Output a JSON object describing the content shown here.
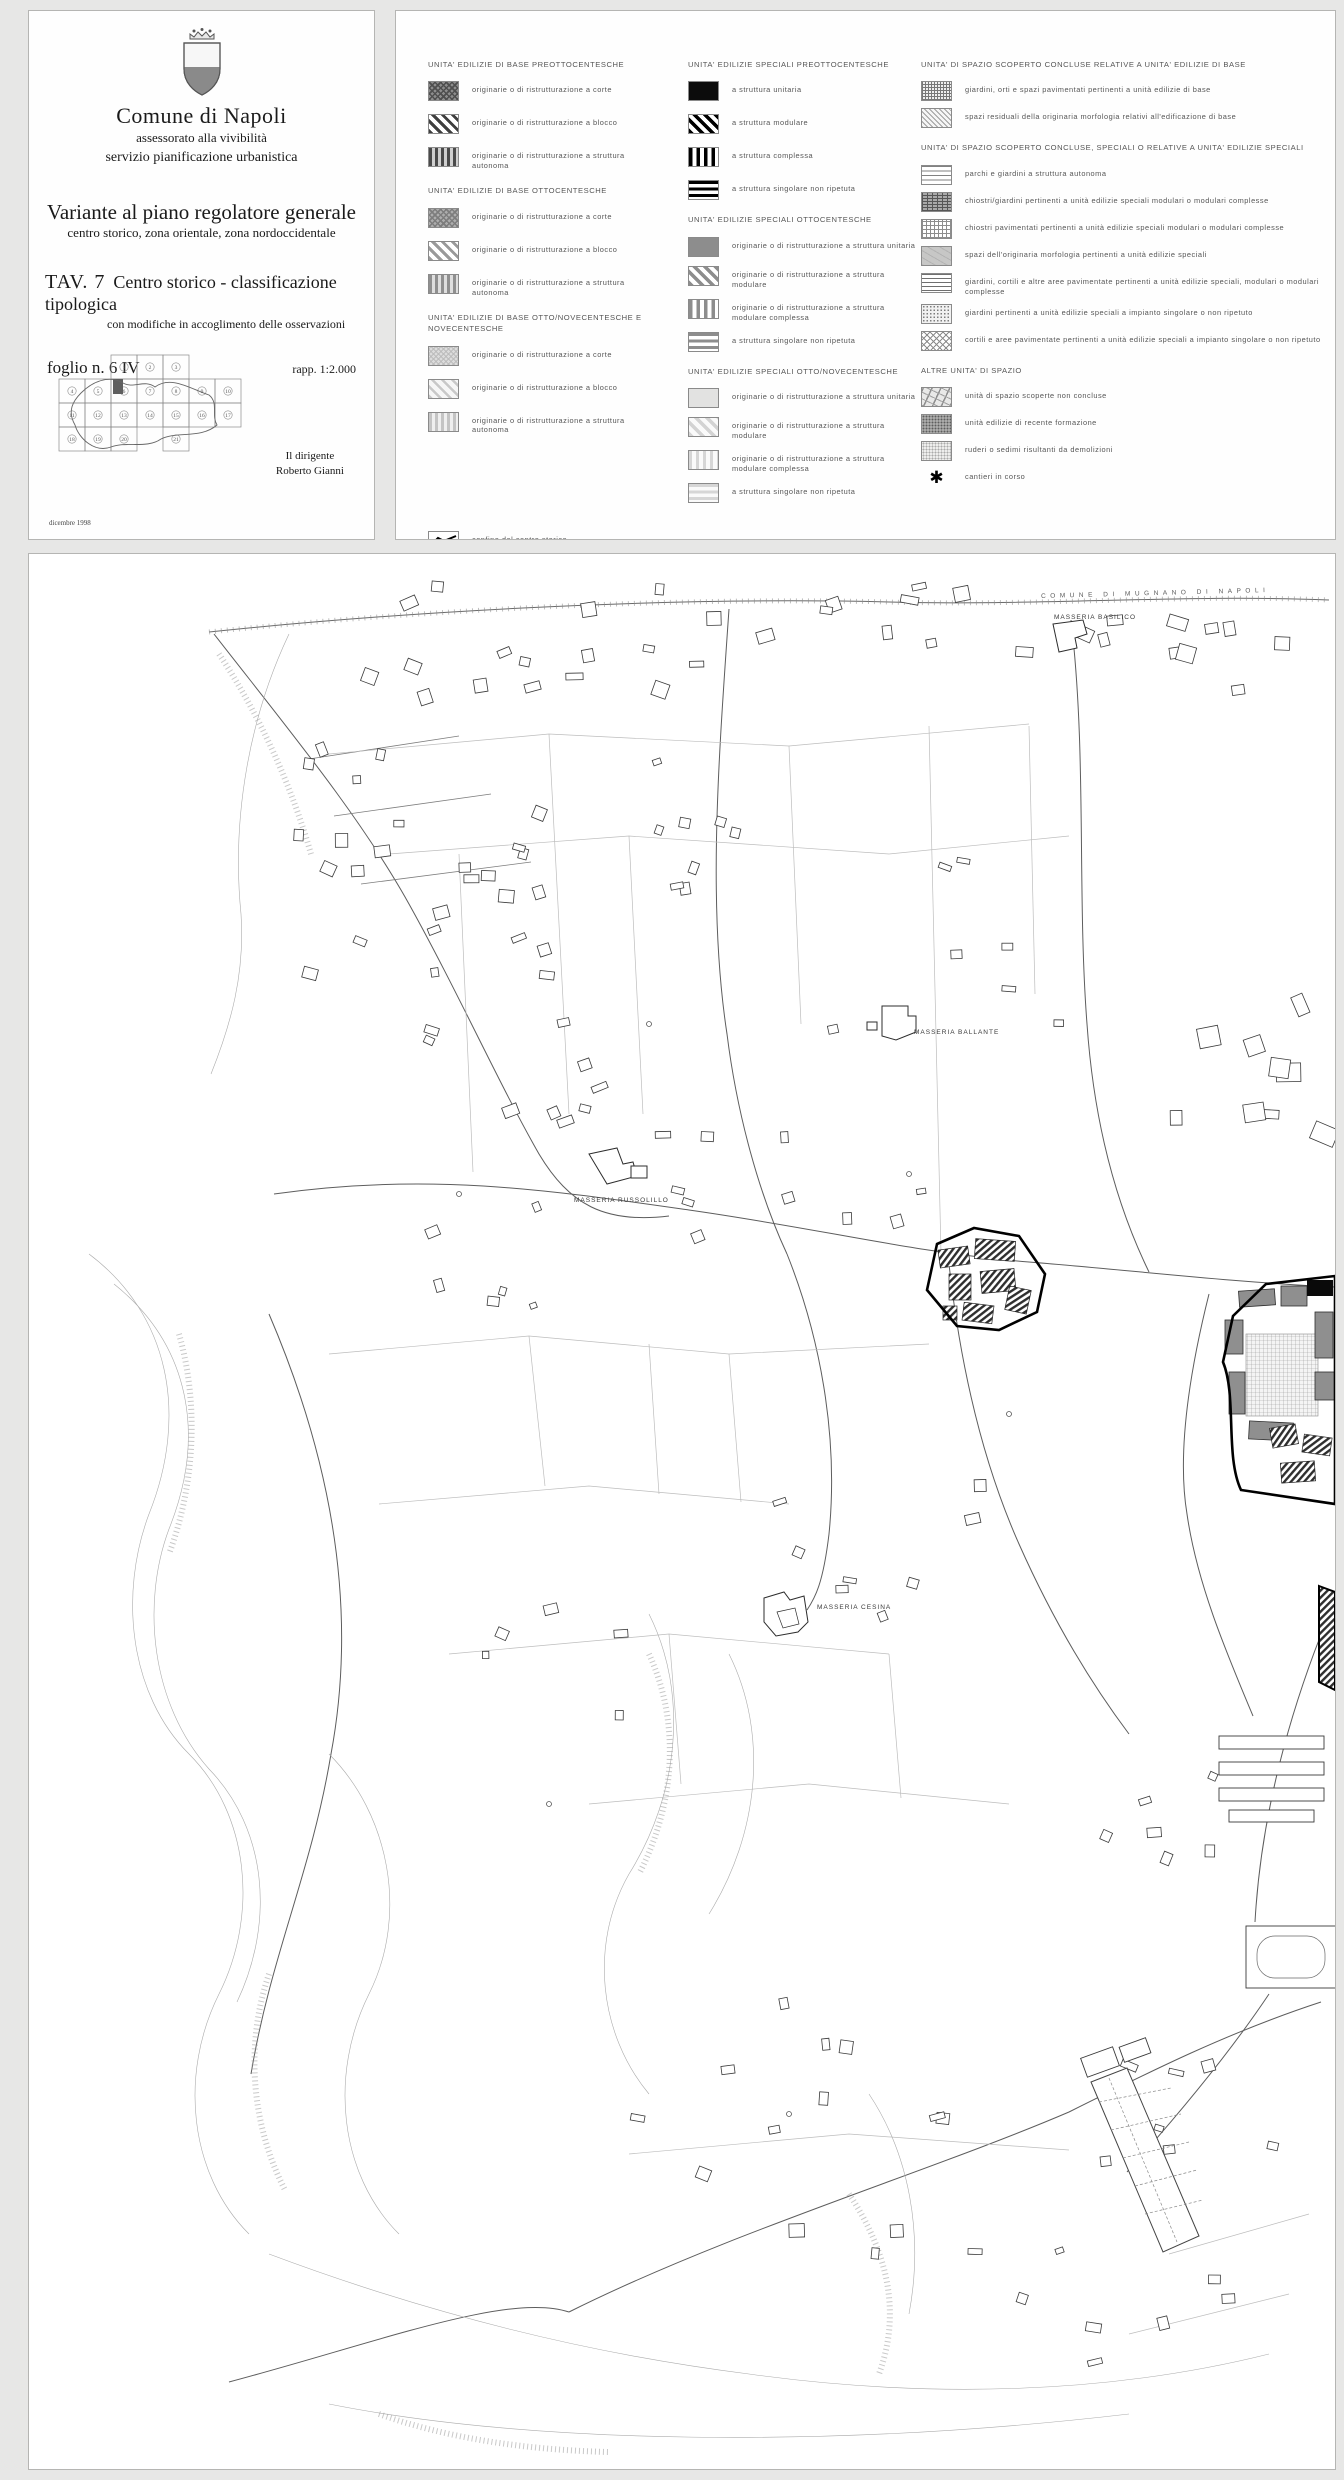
{
  "colors": {
    "ink": "#1a1a1a",
    "legend_text": "#565656",
    "map_line": "#444444",
    "historic_boundary": "#000000",
    "paper": "#ffffff",
    "shield_gray": "#8a8a8a"
  },
  "title_block": {
    "org": "Comune di Napoli",
    "dept1": "assessorato alla vivibilità",
    "dept2": "servizio pianificazione urbanistica",
    "plan_title": "Variante al piano regolatore generale",
    "plan_subtitle": "centro storico, zona orientale, zona nordoccidentale",
    "tav_no": "TAV. 7",
    "tav_title": "Centro storico - classificazione tipologica",
    "tav_note": "con modifiche in accoglimento delle osservazioni",
    "sheet": "foglio n. 6 IV",
    "scale": "rapp. 1:2.000",
    "signature_role": "Il dirigente",
    "signature_name": "Roberto Gianni",
    "date": "dicembre 1998",
    "index_map": {
      "sheet_numbers": [
        "1",
        "2",
        "3",
        "4",
        "5",
        "6",
        "7",
        "8",
        "9",
        "10",
        "11",
        "12",
        "13",
        "14",
        "15",
        "16",
        "17",
        "18",
        "19",
        "20",
        "21"
      ],
      "highlighted_sheet": "6"
    }
  },
  "legend": {
    "columns": [
      {
        "groups": [
          {
            "title": "UNITA' EDILIZIE DI BASE PREOTTOCENTESCHE",
            "items": [
              {
                "pattern": "xh-dark",
                "label": "originarie o di ristrutturazione a corte"
              },
              {
                "pattern": "dg-dark",
                "label": "originarie o di ristrutturazione a blocco"
              },
              {
                "pattern": "vb-dark",
                "label": "originarie o di ristrutturazione a struttura autonoma"
              }
            ]
          },
          {
            "title": "UNITA' EDILIZIE DI BASE OTTOCENTESCHE",
            "items": [
              {
                "pattern": "xh-mid",
                "label": "originarie o di ristrutturazione a corte"
              },
              {
                "pattern": "dg-mid",
                "label": "originarie o di ristrutturazione a blocco"
              },
              {
                "pattern": "vb-mid",
                "label": "originarie o di ristrutturazione a struttura autonoma"
              }
            ]
          },
          {
            "title": "UNITA' EDILIZIE DI BASE OTTO/NOVECENTESCHE E NOVECENTESCHE",
            "items": [
              {
                "pattern": "xh-light",
                "label": "originarie o di ristrutturazione a corte"
              },
              {
                "pattern": "dg-light",
                "label": "originarie o di ristrutturazione a blocco"
              },
              {
                "pattern": "vb-light",
                "label": "originarie o di ristrutturazione a struttura autonoma"
              }
            ]
          },
          {
            "title": "",
            "items": [
              {
                "pattern": "boundary-line",
                "label": "confine del centro storico"
              }
            ]
          }
        ]
      },
      {
        "groups": [
          {
            "title": "UNITA' EDILIZIE SPECIALI PREOTTOCENTESCHE",
            "items": [
              {
                "pattern": "solid-black",
                "label": "a struttura unitaria"
              },
              {
                "pattern": "dg-black",
                "label": "a struttura modulare"
              },
              {
                "pattern": "vb-black",
                "label": "a struttura complessa"
              },
              {
                "pattern": "hb-black",
                "label": "a struttura singolare non ripetuta"
              }
            ]
          },
          {
            "title": "UNITA' EDILIZIE SPECIALI OTTOCENTESCHE",
            "items": [
              {
                "pattern": "solid-gray",
                "label": "originarie o di ristrutturazione a struttura unitaria"
              },
              {
                "pattern": "dg-gray",
                "label": "originarie o di ristrutturazione a struttura modulare"
              },
              {
                "pattern": "vb-gray",
                "label": "originarie o di ristrutturazione a struttura modulare complessa"
              },
              {
                "pattern": "hb-gray",
                "label": "a struttura singolare non ripetuta"
              }
            ]
          },
          {
            "title": "UNITA' EDILIZIE SPECIALI OTTO/NOVECENTESCHE",
            "items": [
              {
                "pattern": "solid-lgray",
                "label": "originarie o di ristrutturazione a struttura unitaria"
              },
              {
                "pattern": "dg-lgray",
                "label": "originarie o di ristrutturazione a struttura modulare"
              },
              {
                "pattern": "vb-lgray",
                "label": "originarie o di ristrutturazione a struttura modulare complessa"
              },
              {
                "pattern": "hb-lgray",
                "label": "a struttura singolare non ripetuta"
              }
            ]
          }
        ]
      },
      {
        "groups": [
          {
            "title": "UNITA' DI SPAZIO SCOPERTO CONCLUSE RELATIVE A UNITA' EDILIZIE DI BASE",
            "items": [
              {
                "pattern": "grid-mid",
                "label": "giardini, orti e spazi pavimentati pertinenti a unità edilizie di base"
              },
              {
                "pattern": "dg-fine",
                "label": "spazi residuali della originaria morfologia relativi all'edificazione di base"
              }
            ]
          },
          {
            "title": "UNITA' DI SPAZIO SCOPERTO CONCLUSE, SPECIALI O RELATIVE A UNITA' EDILIZIE SPECIALI",
            "items": [
              {
                "pattern": "hl-open",
                "label": "parchi e giardini a struttura autonoma"
              },
              {
                "pattern": "grid-dense",
                "label": "chiostri/giardini pertinenti a unità edilizie speciali modulari o modulari complesse"
              },
              {
                "pattern": "grid-open",
                "label": "chiostri pavimentati pertinenti a unità edilizie speciali modulari o modulari complesse"
              },
              {
                "pattern": "gray-noise",
                "label": "spazi dell'originaria morfologia pertinenti a unità edilizie speciali"
              },
              {
                "pattern": "hl-dense",
                "label": "giardini, cortili e altre aree pavimentate pertinenti a unità edilizie speciali, modulari o modulari complesse"
              },
              {
                "pattern": "dots-lat",
                "label": "giardini pertinenti a unità edilizie speciali a impianto singolare o non ripetuto"
              },
              {
                "pattern": "diamond",
                "label": "cortili e aree pavimentate pertinenti a unità edilizie speciali a impianto singolare o non ripetuto"
              }
            ]
          },
          {
            "title": "ALTRE UNITA' DI SPAZIO",
            "items": [
              {
                "pattern": "map-sketch",
                "label": "unità di spazio scoperte non concluse"
              },
              {
                "pattern": "dots-dense",
                "label": "unità edilizie di recente formazione"
              },
              {
                "pattern": "dots-light",
                "label": "ruderi o sedimi risultanti da demolizioni"
              },
              {
                "pattern": "asterisk",
                "label": "cantieri in corso"
              }
            ]
          }
        ]
      }
    ]
  },
  "map": {
    "labels": [
      {
        "text": "COMUNE  DI  MUGNANO  DI  NAPOLI",
        "x": 1012,
        "y": 36,
        "kind": "boundary-name"
      },
      {
        "text": "MASSERIA BASILICO",
        "x": 1025,
        "y": 60,
        "kind": "place"
      },
      {
        "text": "MASSERIA BALLANTE",
        "x": 885,
        "y": 475,
        "kind": "place"
      },
      {
        "text": "MASSERIA RUSSOLILLO",
        "x": 545,
        "y": 643,
        "kind": "place"
      },
      {
        "text": "MASSERIA CESINA",
        "x": 788,
        "y": 1050,
        "kind": "place"
      }
    ]
  }
}
